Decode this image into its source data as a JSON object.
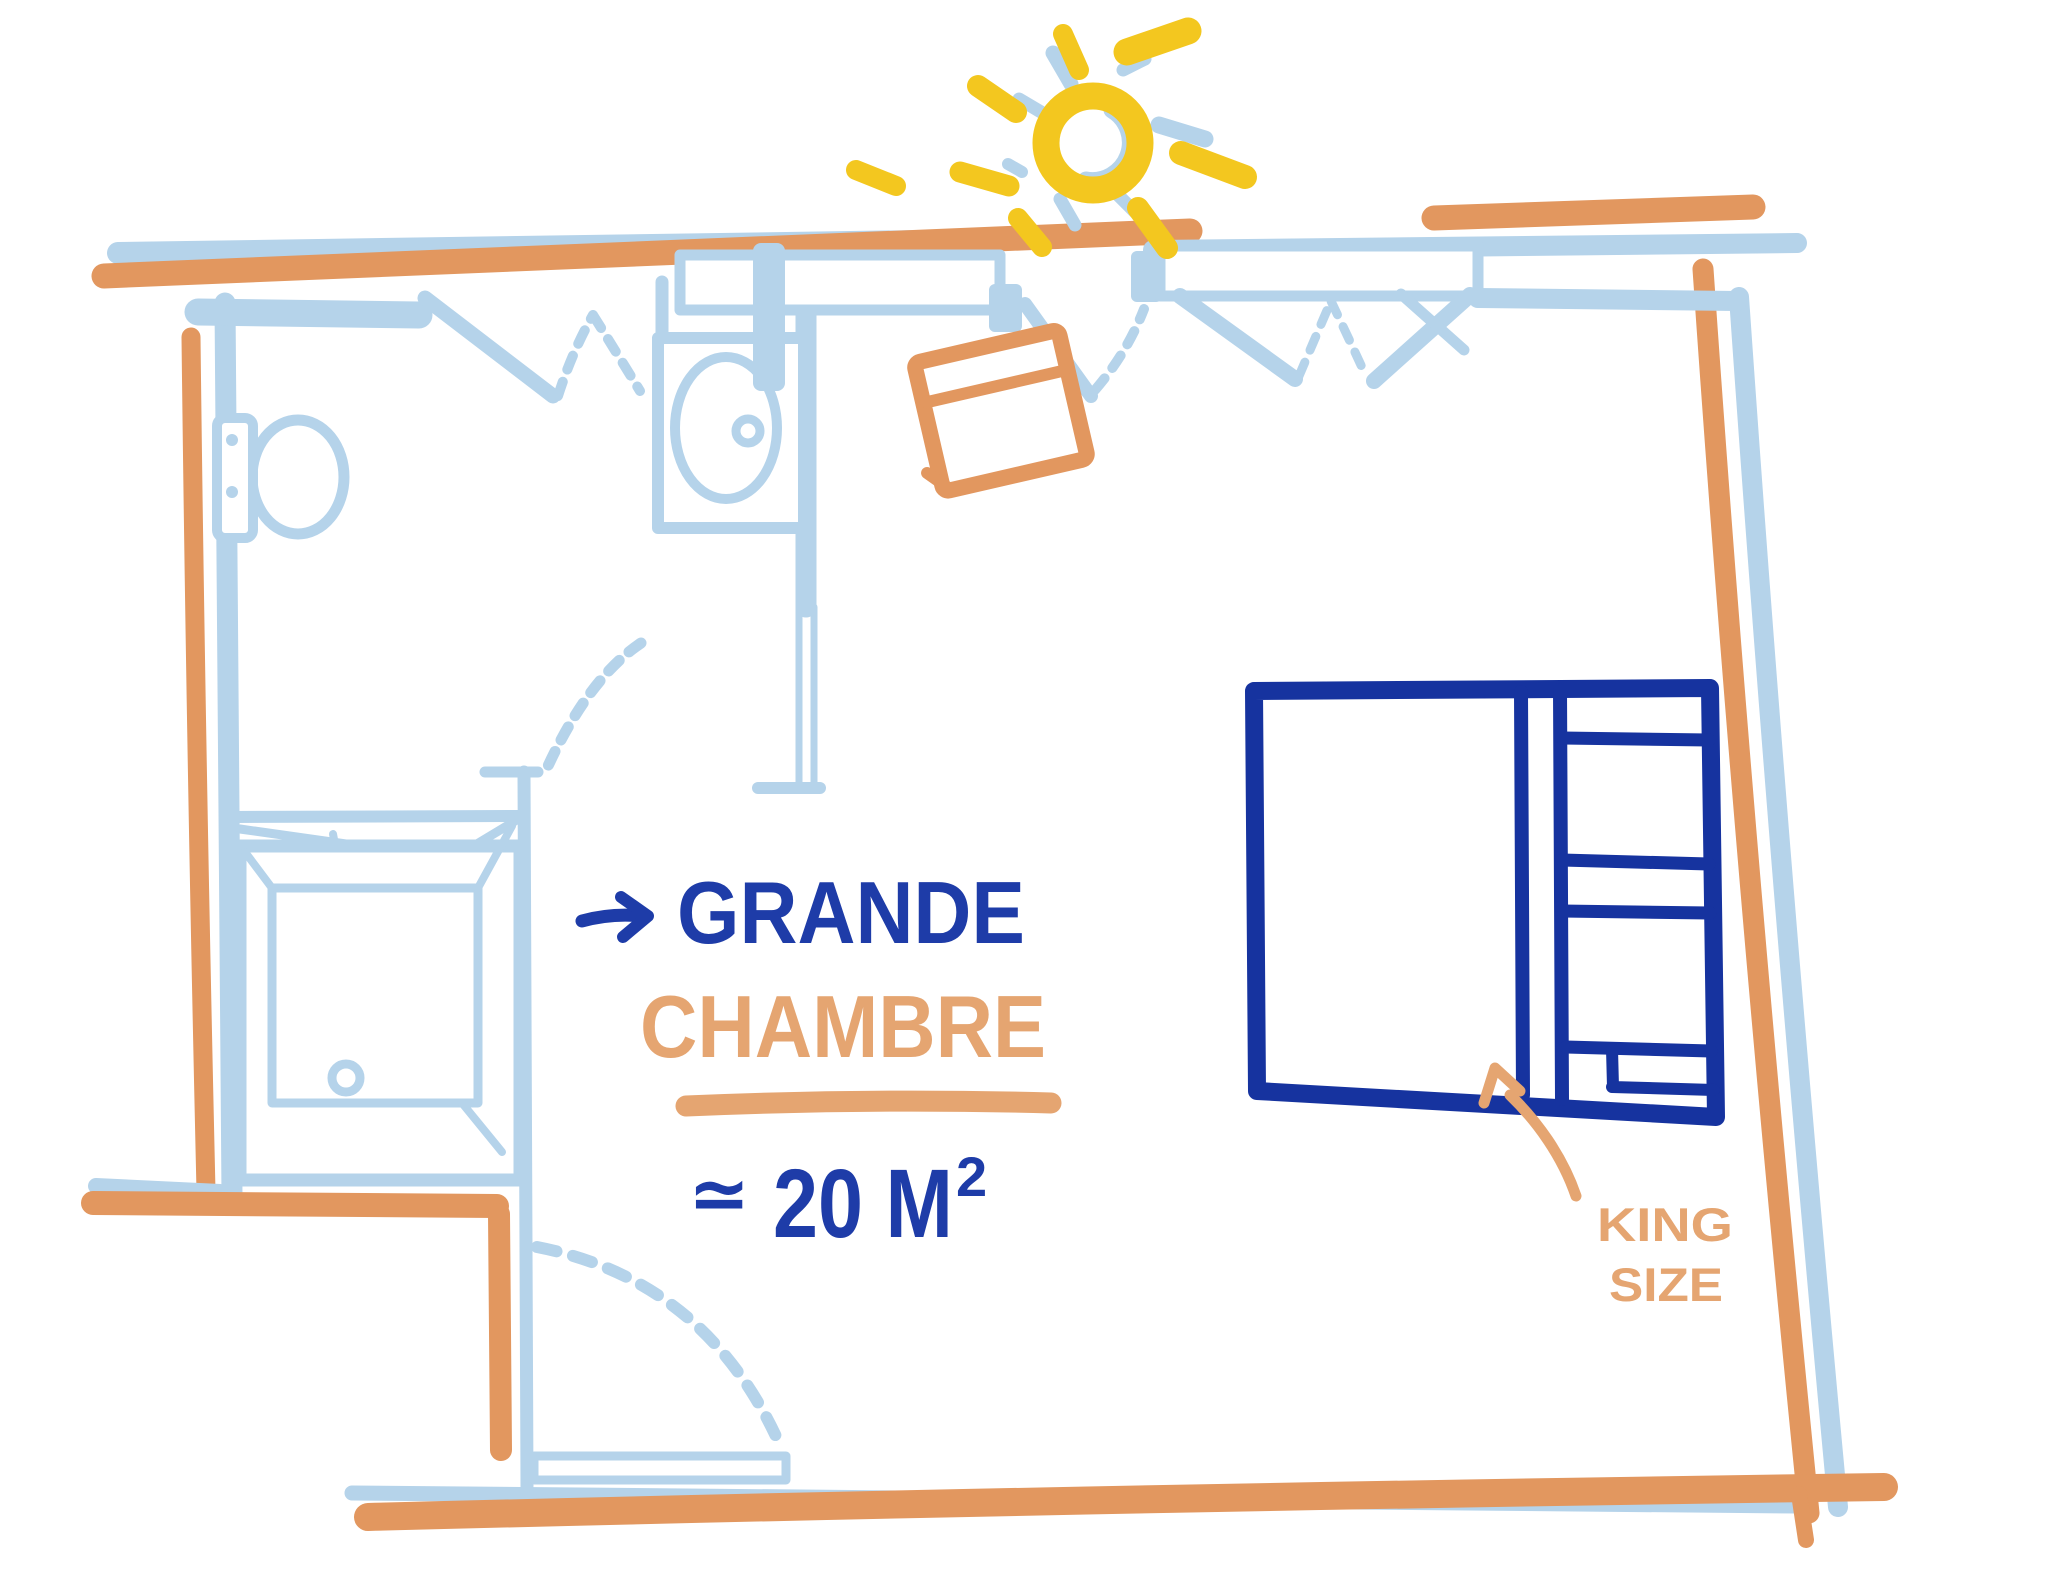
{
  "floor_plan": {
    "room_label": {
      "arrow_icon": "→",
      "line1": "GRANDE",
      "line2": "CHAMBRE",
      "area_symbol": "≃",
      "area_value": "20 M",
      "area_superscript": "2"
    },
    "bed_annotation": {
      "line1": "KING",
      "line2": "SIZE"
    },
    "fixtures": [
      "sun-icon",
      "window-icon",
      "french-door-icon",
      "door-swing-icon",
      "toilet-icon",
      "sink-icon",
      "shower-icon",
      "chair-icon",
      "king-size-bed-icon"
    ],
    "colors": {
      "wall_blue": "#B5D3EA",
      "wall_orange": "#E2975F",
      "text_blue": "#1E3CA8",
      "text_orange": "#E5A571",
      "bed_blue": "#16339F",
      "sun_yellow": "#F3C71F",
      "background": "#FFFFFF"
    }
  }
}
